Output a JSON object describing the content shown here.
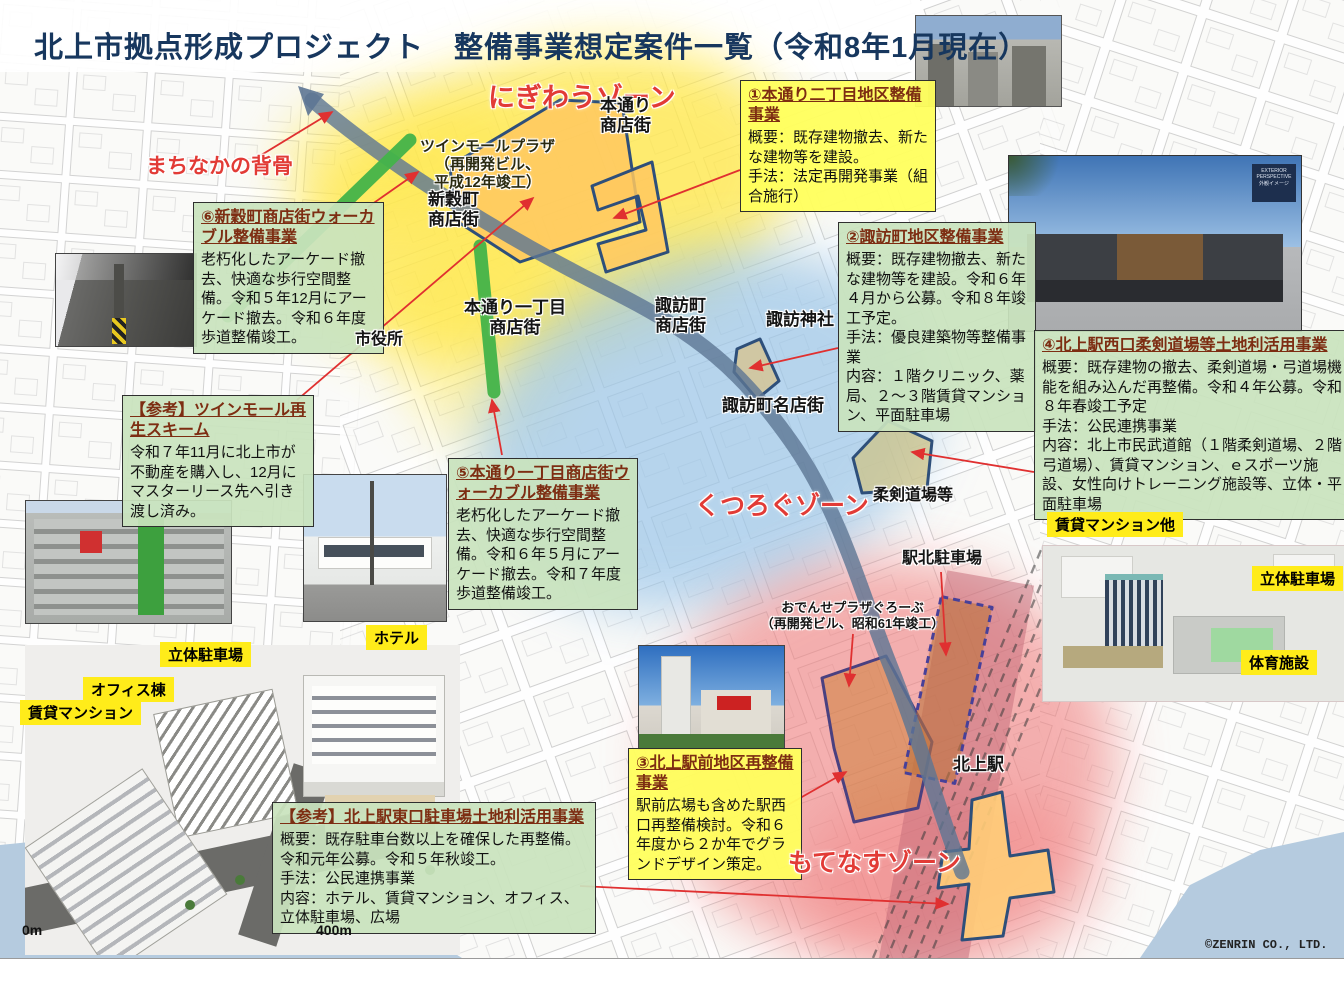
{
  "title": "北上市拠点形成プロジェクト　整備事業想定案件一覧（令和8年1月現在）",
  "copyright": "©ZENRIN CO., LTD.",
  "scale_bar": {
    "start": "0m",
    "end": "400m"
  },
  "colors": {
    "title_navy": "#17375e",
    "zone_yellow": "#ffe84d",
    "zone_blue": "#9cc6e8",
    "zone_red": "#f07d7d",
    "backbone_slate": "#5d7693",
    "walkable_green": "#44b449",
    "box_green": "#c9e3bd",
    "box_yellow": "#ffff5d",
    "label_red": "#e23b36",
    "tag_yellow": "#ffec1a",
    "parcel_border_navy": "#2e4f7a"
  },
  "zone_labels": {
    "nigiwau": "にぎわうゾーン",
    "kutsurogu": "くつろぐゾーン",
    "motenasu": "もてなすゾーン",
    "backbone": "まちなかの背骨"
  },
  "callouts": {
    "c1": {
      "title": "①本通り二丁目地区整備事業",
      "body": "概要：既存建物撤去、新たな建物等を建設。\n手法：法定再開発事業（組合施行）"
    },
    "c2": {
      "title": "②諏訪町地区整備事業",
      "body": "概要：既存建物撤去、新たな建物等を建設。令和６年４月から公募。令和８年竣工予定。\n手法：優良建築物等整備事業\n内容：１階クリニック、薬局、２～３階賃貸マンション、平面駐車場"
    },
    "c3": {
      "title": "③北上駅前地区再整備事業",
      "body": "駅前広場も含めた駅西口再整備検討。令和６年度から２か年でグランドデザイン策定。"
    },
    "c4": {
      "title": "④北上駅西口柔剣道場等土地利活用事業",
      "body": "概要：既存建物の撤去、柔剣道場・弓道場機能を組み込んだ再整備。令和４年公募。令和８年春竣工予定\n手法：公民連携事業\n内容：北上市民武道館（１階柔剣道場、２階弓道場）、賃貸マンション、ｅスポーツ施設、女性向けトレーニング施設等、立体・平面駐車場"
    },
    "c5": {
      "title": "⑤本通り一丁目商店街ウォーカブル整備事業",
      "body": "老朽化したアーケード撤去、快適な歩行空間整備。令和６年５月にアーケード撤去。令和７年度歩道整備竣工。"
    },
    "c6": {
      "title": "⑥新穀町商店街ウォーカブル整備事業",
      "body": "老朽化したアーケード撤去、快適な歩行空間整備。令和５年12月にアーケード撤去。令和６年度歩道整備竣工。"
    },
    "ref1": {
      "title": "【参考】ツインモール再生スキーム",
      "body": "令和７年11月に北上市が不動産を購入し、12月にマスターリース先へ引き渡し済み。"
    },
    "ref2": {
      "title": "【参考】北上駅東口駐車場土地利活用事業",
      "body": "概要：既存駐車台数以上を確保した再整備。令和元年公募。令和５年秋竣工。\n手法：公民連携事業\n内容：ホテル、賃貸マンション、オフィス、立体駐車場、広場"
    }
  },
  "map_labels": [
    {
      "text": "本通り\n商店街"
    },
    {
      "text": "ツインモールプラザ\n（再開発ビル、\n平成12年竣工）"
    },
    {
      "text": "新穀町\n商店街"
    },
    {
      "text": "本通り一丁目\n商店街"
    },
    {
      "text": "市役所"
    },
    {
      "text": "諏訪町\n商店街"
    },
    {
      "text": "諏訪神社"
    },
    {
      "text": "諏訪町名店街"
    },
    {
      "text": "柔剣道場等"
    },
    {
      "text": "駅北駐車場"
    },
    {
      "text": "おでんせプラザぐろーぶ\n（再開発ビル、昭和61年竣工）"
    },
    {
      "text": "北上駅"
    }
  ],
  "tags": [
    {
      "text": "賃貸マンション他"
    },
    {
      "text": "立体駐車場"
    },
    {
      "text": "体育施設"
    },
    {
      "text": "ホテル"
    },
    {
      "text": "立体駐車場"
    },
    {
      "text": "オフィス棟"
    },
    {
      "text": "賃貸マンション"
    }
  ],
  "photos": {
    "exterior_chip": "EXTERIOR\nPERSPECTIVE\n外観イメージ"
  }
}
